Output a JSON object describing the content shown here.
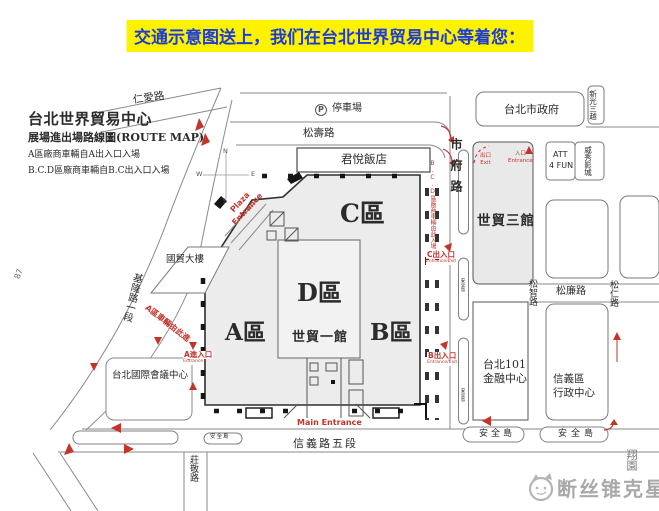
{
  "banner": {
    "text": "交通示意图送上，我们在台北世界贸易中心等着您："
  },
  "legend": {
    "title": "台北世界貿易中心",
    "subtitle": "展場進出場路線圖(ROUTE MAP)",
    "note_a": "A區廠商車輛自A出入口入場",
    "note_bcd": "B.C.D區廠商車輛自B.C出入口入場"
  },
  "roads": {
    "renai": "仁愛路",
    "songshou": "松壽路",
    "shifu": "市府路",
    "jilong": "基隆路一段",
    "xinyi": "信義路五段",
    "zhuangjing": "莊敬路",
    "songzhi": "松智路",
    "songlian": "松廉路",
    "songren": "松仁路",
    "marker": "87",
    "corner": "翔園"
  },
  "places": {
    "parking_icon": "P",
    "parking": "停車場",
    "hyatt": "君悅飯店",
    "cityhall": "台北市政府",
    "skm": "新光三越",
    "att_l1": "ATT",
    "att_l2": "4 FUN",
    "vieshow": "威秀影城",
    "hall3": "世貿三館",
    "itb": "國貿大樓",
    "ticc": "台北國際會議中心",
    "t101_l1": "台北101",
    "t101_l2": "金融中心",
    "admin_l1": "信義區",
    "admin_l2": "行政中心"
  },
  "halls": {
    "a": "A區",
    "b": "B區",
    "c": "C區",
    "d": "D區",
    "hall1": "世貿一館"
  },
  "gates": {
    "plaza_l1": "Plaza",
    "plaza_l2": "Entrance",
    "main": "Main Entrance",
    "a_in": "A進入口",
    "b_out": "B出入口",
    "c_out": "C出入口",
    "sub_in": "Entrance",
    "sub_inout": "Entrance/Exit",
    "hall3_out_l1": "出口",
    "hall3_out_l2": "Exit",
    "hall3_in_l1": "入口",
    "hall3_in_l2": "Entrance"
  },
  "routes": {
    "a_note": "A區車輛由此進",
    "bcd_note": "B.C.D區廠商車輛由此入場"
  },
  "islands": {
    "label": "安全島"
  },
  "compass": {
    "n": "N",
    "e": "E",
    "s": "S",
    "w": "W"
  },
  "watermark": {
    "text": "断丝锥克星"
  },
  "colors": {
    "banner_bg": "#fff200",
    "banner_text": "#1b3cd6",
    "route_red": "#c2342c"
  }
}
